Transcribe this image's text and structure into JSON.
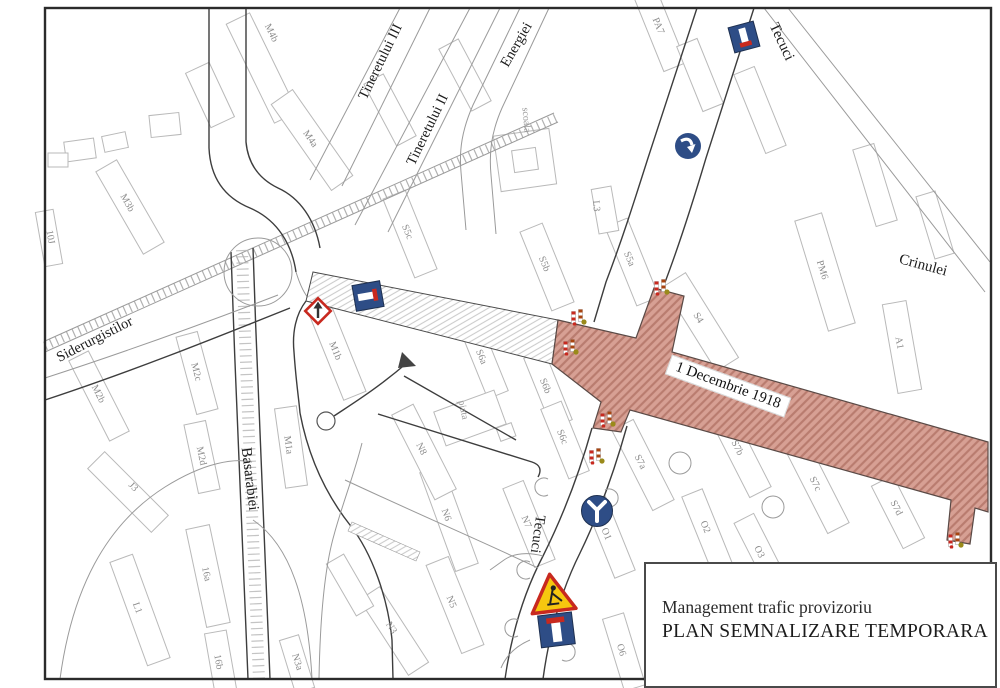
{
  "title_block": {
    "line1": "Management trafic provizoriu",
    "line2": "PLAN SEMNALIZARE TEMPORARA"
  },
  "road_label": {
    "text": "1 Decembrie 1918",
    "x": 728,
    "y": 386,
    "rot": 20
  },
  "colors": {
    "closed_road_fill": "#d7a094",
    "closed_road_hatch": "#b97c6f",
    "sign_blue": "#2e4d86",
    "sign_red": "#c8291f",
    "warning_yellow": "#f6c70f"
  },
  "streets": [
    {
      "label": "Tecuci",
      "x": 781,
      "y": 42,
      "rot": 65,
      "size": 15
    },
    {
      "label": "Crinulei",
      "x": 923,
      "y": 266,
      "rot": 15,
      "size": 15
    },
    {
      "label": "Siderurgistilor",
      "x": 95,
      "y": 340,
      "rot": -27,
      "size": 14.5
    },
    {
      "label": "Basarabiei",
      "x": 249,
      "y": 479,
      "rot": 83,
      "size": 15
    },
    {
      "label": "Energiei",
      "x": 517,
      "y": 45,
      "rot": -60,
      "size": 14.5
    },
    {
      "label": "Tineretului II",
      "x": 428,
      "y": 130,
      "rot": -64,
      "size": 14.5
    },
    {
      "label": "Tineretului III",
      "x": 381,
      "y": 62,
      "rot": -64,
      "size": 14.5
    },
    {
      "label": "Tecuci",
      "x": 537,
      "y": 534,
      "rot": 98,
      "size": 14.5
    }
  ],
  "area_labels": [
    {
      "label": "scoala",
      "x": 526,
      "y": 120,
      "rot": 85
    },
    {
      "label": "piata",
      "x": 463,
      "y": 410,
      "rot": 78
    }
  ],
  "blocks": [
    {
      "label": "M4b",
      "x": 271,
      "y": 33,
      "rot": 64
    },
    {
      "label": "M4a",
      "x": 310,
      "y": 139,
      "rot": 55
    },
    {
      "label": "M3b",
      "x": 127,
      "y": 203,
      "rot": 60
    },
    {
      "label": "10J",
      "x": 50,
      "y": 237,
      "rot": 80
    },
    {
      "label": "M2c",
      "x": 196,
      "y": 372,
      "rot": 75
    },
    {
      "label": "M2b",
      "x": 98,
      "y": 394,
      "rot": 63
    },
    {
      "label": "M2d",
      "x": 201,
      "y": 456,
      "rot": 78
    },
    {
      "label": "M1b",
      "x": 335,
      "y": 351,
      "rot": 68
    },
    {
      "label": "M1a",
      "x": 288,
      "y": 445,
      "rot": 82
    },
    {
      "label": "J3",
      "x": 133,
      "y": 487,
      "rot": 45
    },
    {
      "label": "L1",
      "x": 137,
      "y": 608,
      "rot": 70
    },
    {
      "label": "16a",
      "x": 206,
      "y": 574,
      "rot": 78
    },
    {
      "label": "16b",
      "x": 218,
      "y": 662,
      "rot": 80
    },
    {
      "label": "N3a",
      "x": 297,
      "y": 662,
      "rot": 73
    },
    {
      "label": "N3",
      "x": 391,
      "y": 628,
      "rot": 57
    },
    {
      "label": "N5",
      "x": 451,
      "y": 602,
      "rot": 68
    },
    {
      "label": "N6",
      "x": 446,
      "y": 515,
      "rot": 70
    },
    {
      "label": "N7",
      "x": 526,
      "y": 522,
      "rot": 68
    },
    {
      "label": "N8",
      "x": 421,
      "y": 449,
      "rot": 63
    },
    {
      "label": "O1",
      "x": 606,
      "y": 534,
      "rot": 68
    },
    {
      "label": "O2",
      "x": 705,
      "y": 527,
      "rot": 68
    },
    {
      "label": "O3",
      "x": 759,
      "y": 552,
      "rot": 63
    },
    {
      "label": "O6",
      "x": 621,
      "y": 650,
      "rot": 73
    },
    {
      "label": "S5c",
      "x": 407,
      "y": 232,
      "rot": 68
    },
    {
      "label": "S5b",
      "x": 544,
      "y": 264,
      "rot": 68
    },
    {
      "label": "S5a",
      "x": 629,
      "y": 259,
      "rot": 68
    },
    {
      "label": "S6a",
      "x": 481,
      "y": 357,
      "rot": 68
    },
    {
      "label": "S6b",
      "x": 545,
      "y": 386,
      "rot": 68
    },
    {
      "label": "S6c",
      "x": 562,
      "y": 437,
      "rot": 68
    },
    {
      "label": "S4",
      "x": 698,
      "y": 318,
      "rot": 58
    },
    {
      "label": "PM6",
      "x": 822,
      "y": 270,
      "rot": 73
    },
    {
      "label": "A1",
      "x": 899,
      "y": 343,
      "rot": 80
    },
    {
      "label": "PA7",
      "x": 658,
      "y": 26,
      "rot": 68
    },
    {
      "label": "S7a",
      "x": 640,
      "y": 462,
      "rot": 63
    },
    {
      "label": "S7b",
      "x": 737,
      "y": 448,
      "rot": 63
    },
    {
      "label": "S7c",
      "x": 815,
      "y": 484,
      "rot": 63
    },
    {
      "label": "S7d",
      "x": 896,
      "y": 508,
      "rot": 63
    },
    {
      "label": "L3",
      "x": 596,
      "y": 206,
      "rot": 85
    }
  ],
  "signs": [
    {
      "type": "dead_end_n",
      "name": "dead-end-ahead-sign-north",
      "x": 744,
      "y": 37,
      "rot": -15
    },
    {
      "type": "curve_arrow",
      "name": "turn-right-curve-sign",
      "x": 688,
      "y": 146,
      "rot": 0
    },
    {
      "type": "dead_end_w",
      "name": "dead-end-ahead-sign-west",
      "x": 368,
      "y": 296,
      "rot": -10
    },
    {
      "type": "detour_diamond",
      "name": "detour-direction-sign",
      "x": 318,
      "y": 311,
      "rot": 0
    },
    {
      "type": "y_junction",
      "name": "road-fork-sign",
      "x": 597,
      "y": 511,
      "rot": 0
    },
    {
      "type": "roadworks_combo",
      "name": "roadworks-dead-end-sign",
      "x": 554,
      "y": 610,
      "rot": -7
    },
    {
      "type": "work_marker",
      "name": "work-zone-marker-1",
      "x": 662,
      "y": 287,
      "rot": 0
    },
    {
      "type": "work_marker",
      "name": "work-zone-marker-2",
      "x": 579,
      "y": 317,
      "rot": 0
    },
    {
      "type": "work_marker",
      "name": "work-zone-marker-3",
      "x": 571,
      "y": 347,
      "rot": 0
    },
    {
      "type": "work_marker",
      "name": "work-zone-marker-4",
      "x": 608,
      "y": 419,
      "rot": 0
    },
    {
      "type": "work_marker",
      "name": "work-zone-marker-5",
      "x": 597,
      "y": 456,
      "rot": 0
    },
    {
      "type": "work_marker",
      "name": "work-zone-marker-6",
      "x": 956,
      "y": 540,
      "rot": 0
    }
  ]
}
